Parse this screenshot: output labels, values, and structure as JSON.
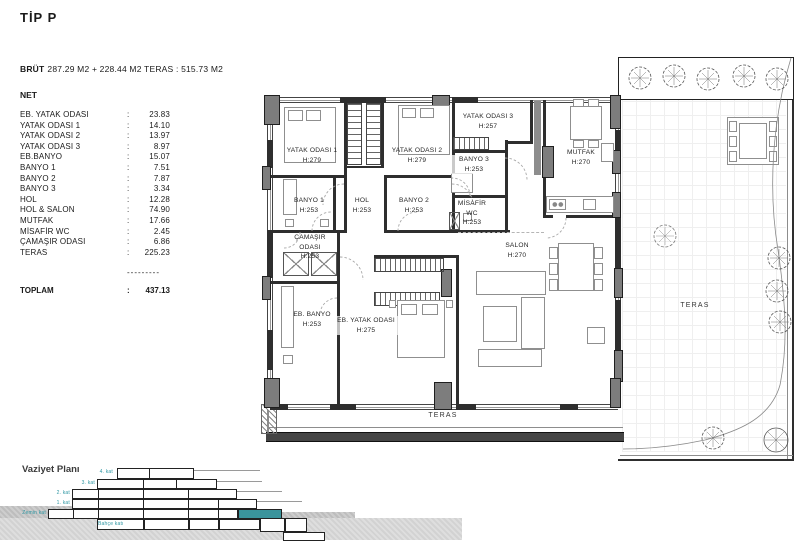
{
  "title": "TİP P",
  "summary": {
    "brut_label": "BRÜT",
    "brut_value": "287.29 M2 + 228.44 M2 TERAS : 515.73 M2",
    "net_label": "NET",
    "rooms": [
      {
        "name": "EB. YATAK ODASI",
        "value": "23.83"
      },
      {
        "name": "YATAK ODASI 1",
        "value": "14.10"
      },
      {
        "name": "YATAK ODASI 2",
        "value": "13.97"
      },
      {
        "name": "YATAK ODASI 3",
        "value": "8.97"
      },
      {
        "name": "EB.BANYO",
        "value": "15.07"
      },
      {
        "name": "BANYO 1",
        "value": "7.51"
      },
      {
        "name": "BANYO 2",
        "value": "7.87"
      },
      {
        "name": "BANYO 3",
        "value": "3.34"
      },
      {
        "name": "HOL",
        "value": "12.28"
      },
      {
        "name": "HOL & SALON",
        "value": "74.90"
      },
      {
        "name": "MUTFAK",
        "value": "17.66"
      },
      {
        "name": "MİSAFİR WC",
        "value": "2.45"
      },
      {
        "name": "ÇAMAŞIR ODASI",
        "value": "6.86"
      },
      {
        "name": "TERAS",
        "value": "225.23"
      }
    ],
    "divider": "---------",
    "toplam_label": "TOPLAM",
    "toplam_value": "437.13"
  },
  "plan": {
    "labels": [
      {
        "name": "YATAK ODASI 1",
        "h": "H:279"
      },
      {
        "name": "YATAK ODASI 2",
        "h": "H:279"
      },
      {
        "name": "YATAK ODASI 3",
        "h": "H:257"
      },
      {
        "name": "BANYO 1",
        "h": "H:253"
      },
      {
        "name": "HOL",
        "h": "H:253"
      },
      {
        "name": "BANYO 2",
        "h": "H:253"
      },
      {
        "name": "BANYO 3",
        "h": "H:253"
      },
      {
        "name": "MİSAFİR WC",
        "h": "H:253"
      },
      {
        "name": "MUTFAK",
        "h": "H:270"
      },
      {
        "name": "ÇAMAŞIR ODASI",
        "h": "H:253"
      },
      {
        "name": "EB. BANYO",
        "h": "H:253"
      },
      {
        "name": "EB. YATAK ODASI",
        "h": "H:275"
      },
      {
        "name": "SALON",
        "h": "H:270"
      },
      {
        "name": "TERAS",
        "h": ""
      },
      {
        "name": "TERAS",
        "h": ""
      }
    ]
  },
  "site_plan": {
    "label": "Vaziyet Planı",
    "floors": [
      "4. kat",
      "3. kat",
      "2. kat",
      "1. kat",
      "Zemin kat"
    ],
    "garden_label": "Bahçe katı",
    "highlight_color": "#3A949C"
  }
}
